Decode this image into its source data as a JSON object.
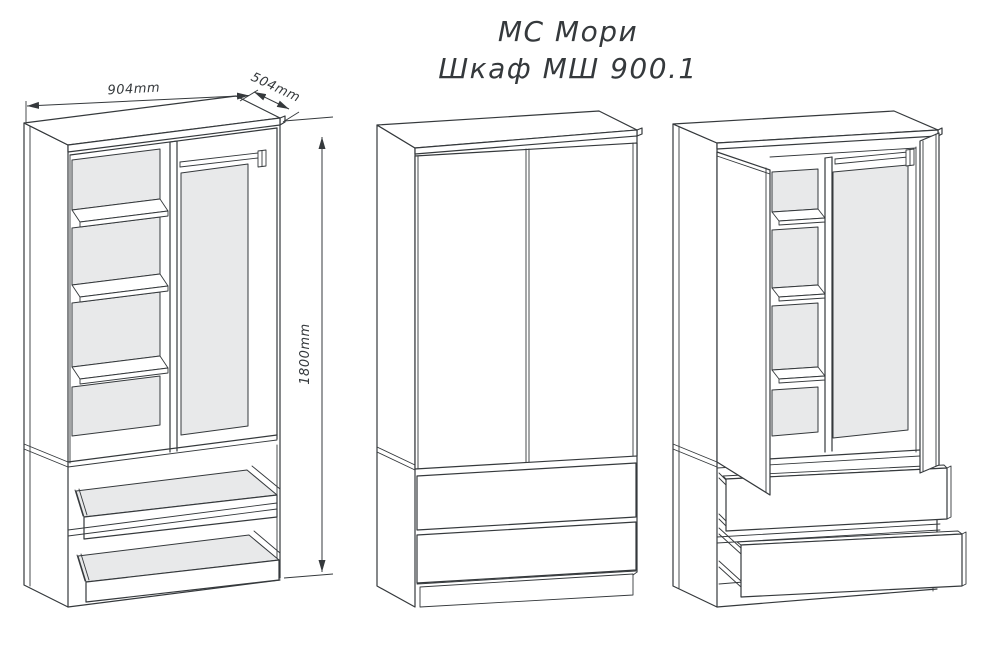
{
  "title": {
    "line1": "МС Мори",
    "line2": "Шкаф МШ 900.1"
  },
  "dimensions": {
    "width_label": "904mm",
    "depth_label": "504mm",
    "height_label": "1800mm"
  },
  "colors": {
    "line": "#35393c",
    "panel_fill": "#e8e9ea",
    "background": "#ffffff"
  }
}
